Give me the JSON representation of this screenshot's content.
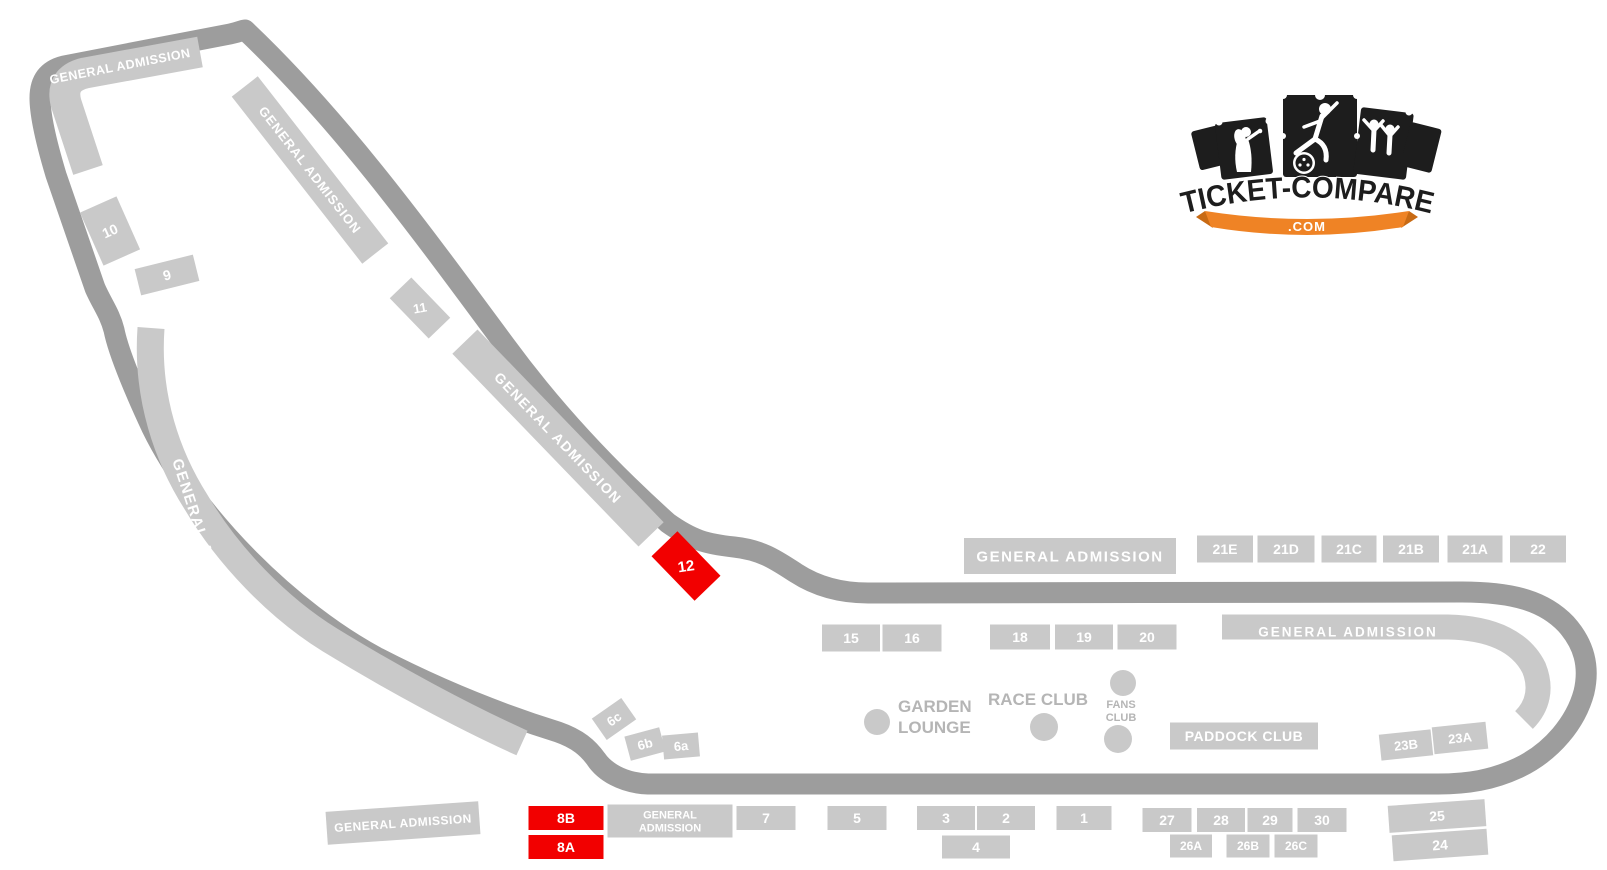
{
  "logo": {
    "title": "TICKET-COMPARE",
    "domain": ".COM"
  },
  "colors": {
    "track": "#9d9d9d",
    "stand": "#c9c9c9",
    "highlight_stand": "#f20000",
    "stand_text": "#ffffff",
    "club_text": "#b5b5b5",
    "logo_black": "#1d1d1d",
    "logo_orange": "#ef8325"
  },
  "stands": [
    {
      "id": "10",
      "label": "10",
      "cx": 110,
      "cy": 231,
      "w": 40,
      "h": 58,
      "rot": -24,
      "fs": 14
    },
    {
      "id": "9",
      "label": "9",
      "cx": 167,
      "cy": 275,
      "w": 60,
      "h": 27,
      "rot": -14,
      "fs": 14
    },
    {
      "id": "ga-back-upper",
      "label": "GENERAL ADMISSION",
      "cx": 310,
      "cy": 170,
      "w": 212,
      "h": 33,
      "rot": 52,
      "fs": 13,
      "ls": 1
    },
    {
      "id": "11",
      "label": "11",
      "cx": 420,
      "cy": 308,
      "w": 56,
      "h": 30,
      "rot": 46,
      "trot": -10,
      "fs": 13
    },
    {
      "id": "ga-back-lower",
      "label": "GENERAL ADMISSION",
      "cx": 558,
      "cy": 438,
      "w": 268,
      "h": 35,
      "rot": 46,
      "fs": 14,
      "ls": 1.5
    },
    {
      "id": "12",
      "label": "12",
      "cx": 686,
      "cy": 566,
      "w": 62,
      "h": 36,
      "rot": 46,
      "trot": -8,
      "fs": 15,
      "highlight": true
    },
    {
      "id": "6c",
      "label": "6c",
      "cx": 614,
      "cy": 719,
      "w": 36,
      "h": 26,
      "rot": -35,
      "fs": 13
    },
    {
      "id": "6b",
      "label": "6b",
      "cx": 645,
      "cy": 744,
      "w": 36,
      "h": 25,
      "rot": -15,
      "fs": 13
    },
    {
      "id": "6a",
      "label": "6a",
      "cx": 681,
      "cy": 746,
      "w": 36,
      "h": 24,
      "rot": -5,
      "fs": 13
    },
    {
      "id": "8B",
      "label": "8B",
      "cx": 566,
      "cy": 818,
      "w": 75,
      "h": 24,
      "rot": 0,
      "fs": 14,
      "highlight": true
    },
    {
      "id": "8A",
      "label": "8A",
      "cx": 566,
      "cy": 847,
      "w": 75,
      "h": 24,
      "rot": 0,
      "fs": 14,
      "highlight": true
    },
    {
      "id": "ga-bottom",
      "label": "GENERAL ADMISSION",
      "cx": 403,
      "cy": 823,
      "w": 153,
      "h": 33,
      "rot": -4,
      "fs": 12,
      "ls": 0.5
    },
    {
      "id": "ga-start",
      "label": "GENERAL\nADMISSION",
      "cx": 670,
      "cy": 821,
      "w": 125,
      "h": 33,
      "rot": 0,
      "fs": 11
    },
    {
      "id": "7",
      "label": "7",
      "cx": 766,
      "cy": 818,
      "w": 59,
      "h": 24,
      "rot": 0,
      "fs": 14
    },
    {
      "id": "5",
      "label": "5",
      "cx": 857,
      "cy": 818,
      "w": 59,
      "h": 24,
      "rot": 0,
      "fs": 14
    },
    {
      "id": "3",
      "label": "3",
      "cx": 946,
      "cy": 818,
      "w": 58,
      "h": 24,
      "rot": 0,
      "fs": 14
    },
    {
      "id": "2",
      "label": "2",
      "cx": 1006,
      "cy": 818,
      "w": 58,
      "h": 24,
      "rot": 0,
      "fs": 14
    },
    {
      "id": "4",
      "label": "4",
      "cx": 976,
      "cy": 847,
      "w": 68,
      "h": 23,
      "rot": 0,
      "fs": 14
    },
    {
      "id": "1",
      "label": "1",
      "cx": 1084,
      "cy": 818,
      "w": 55,
      "h": 24,
      "rot": 0,
      "fs": 14
    },
    {
      "id": "27",
      "label": "27",
      "cx": 1167,
      "cy": 820,
      "w": 49,
      "h": 24,
      "rot": 0,
      "fs": 14
    },
    {
      "id": "28",
      "label": "28",
      "cx": 1221,
      "cy": 820,
      "w": 48,
      "h": 24,
      "rot": 0,
      "fs": 14
    },
    {
      "id": "29",
      "label": "29",
      "cx": 1270,
      "cy": 820,
      "w": 45,
      "h": 24,
      "rot": 0,
      "fs": 14
    },
    {
      "id": "30",
      "label": "30",
      "cx": 1322,
      "cy": 820,
      "w": 49,
      "h": 24,
      "rot": 0,
      "fs": 14
    },
    {
      "id": "26A",
      "label": "26A",
      "cx": 1191,
      "cy": 846,
      "w": 42,
      "h": 23,
      "rot": 0,
      "fs": 12
    },
    {
      "id": "26B",
      "label": "26B",
      "cx": 1248,
      "cy": 846,
      "w": 43,
      "h": 23,
      "rot": 0,
      "fs": 12
    },
    {
      "id": "26C",
      "label": "26C",
      "cx": 1296,
      "cy": 846,
      "w": 43,
      "h": 23,
      "rot": 0,
      "fs": 12
    },
    {
      "id": "25",
      "label": "25",
      "cx": 1437,
      "cy": 816,
      "w": 97,
      "h": 27,
      "rot": -4,
      "fs": 14
    },
    {
      "id": "24",
      "label": "24",
      "cx": 1440,
      "cy": 845,
      "w": 95,
      "h": 26,
      "rot": -4,
      "fs": 14
    },
    {
      "id": "23B",
      "label": "23B",
      "cx": 1406,
      "cy": 745,
      "w": 52,
      "h": 26,
      "rot": -6,
      "fs": 13
    },
    {
      "id": "23A",
      "label": "23A",
      "cx": 1460,
      "cy": 738,
      "w": 54,
      "h": 27,
      "rot": -6,
      "fs": 13
    },
    {
      "id": "paddock-club",
      "label": "PADDOCK CLUB",
      "cx": 1244,
      "cy": 736,
      "w": 148,
      "h": 27,
      "rot": 0,
      "fs": 14,
      "ls": 0.5
    },
    {
      "id": "ga-main",
      "label": "GENERAL ADMISSION",
      "cx": 1070,
      "cy": 556,
      "w": 212,
      "h": 36,
      "rot": 0,
      "fs": 15,
      "ls": 1.5
    },
    {
      "id": "21E",
      "label": "21E",
      "cx": 1225,
      "cy": 549,
      "w": 56,
      "h": 27,
      "rot": 0,
      "fs": 14
    },
    {
      "id": "21D",
      "label": "21D",
      "cx": 1286,
      "cy": 549,
      "w": 57,
      "h": 27,
      "rot": 0,
      "fs": 14
    },
    {
      "id": "21C",
      "label": "21C",
      "cx": 1349,
      "cy": 549,
      "w": 55,
      "h": 27,
      "rot": 0,
      "fs": 14
    },
    {
      "id": "21B",
      "label": "21B",
      "cx": 1411,
      "cy": 549,
      "w": 56,
      "h": 27,
      "rot": 0,
      "fs": 14
    },
    {
      "id": "21A",
      "label": "21A",
      "cx": 1475,
      "cy": 549,
      "w": 55,
      "h": 27,
      "rot": 0,
      "fs": 14
    },
    {
      "id": "22",
      "label": "22",
      "cx": 1538,
      "cy": 549,
      "w": 56,
      "h": 27,
      "rot": 0,
      "fs": 14
    },
    {
      "id": "15",
      "label": "15",
      "cx": 851,
      "cy": 638,
      "w": 58,
      "h": 27,
      "rot": 0,
      "fs": 14
    },
    {
      "id": "16",
      "label": "16",
      "cx": 912,
      "cy": 638,
      "w": 59,
      "h": 27,
      "rot": 0,
      "fs": 14
    },
    {
      "id": "18",
      "label": "18",
      "cx": 1020,
      "cy": 637,
      "w": 60,
      "h": 25,
      "rot": 0,
      "fs": 14
    },
    {
      "id": "19",
      "label": "19",
      "cx": 1084,
      "cy": 637,
      "w": 58,
      "h": 25,
      "rot": 0,
      "fs": 14
    },
    {
      "id": "20",
      "label": "20",
      "cx": 1147,
      "cy": 637,
      "w": 59,
      "h": 25,
      "rot": 0,
      "fs": 14
    }
  ],
  "ga_labels": [
    {
      "id": "ga-corner",
      "text": "GENERAL ADMISSION",
      "x": 120,
      "y": 66,
      "rot": -11,
      "fs": 12.5,
      "ls": 0.5
    },
    {
      "id": "ga-left-curve",
      "text": "GENERAL ADMISSION",
      "x": 206,
      "y": 548,
      "rot": 72,
      "fs": 15,
      "ls": 1.5
    },
    {
      "id": "ga-parabolica",
      "text": "GENERAL ADMISSION",
      "x": 1348,
      "y": 632,
      "rot": 0,
      "fs": 13.5,
      "ls": 2
    }
  ],
  "clubs": [
    {
      "id": "garden-lounge",
      "lines": [
        "GARDEN",
        "LOUNGE"
      ],
      "x": 898,
      "y": 712,
      "lh": 21,
      "fs": 17,
      "anchor": "start"
    },
    {
      "id": "race-club",
      "lines": [
        "RACE CLUB"
      ],
      "x": 1038,
      "y": 705,
      "lh": 18,
      "fs": 17,
      "anchor": "middle"
    },
    {
      "id": "fans-club",
      "lines": [
        "FANS",
        "CLUB"
      ],
      "x": 1121,
      "y": 708,
      "lh": 13,
      "fs": 11,
      "anchor": "middle"
    }
  ]
}
